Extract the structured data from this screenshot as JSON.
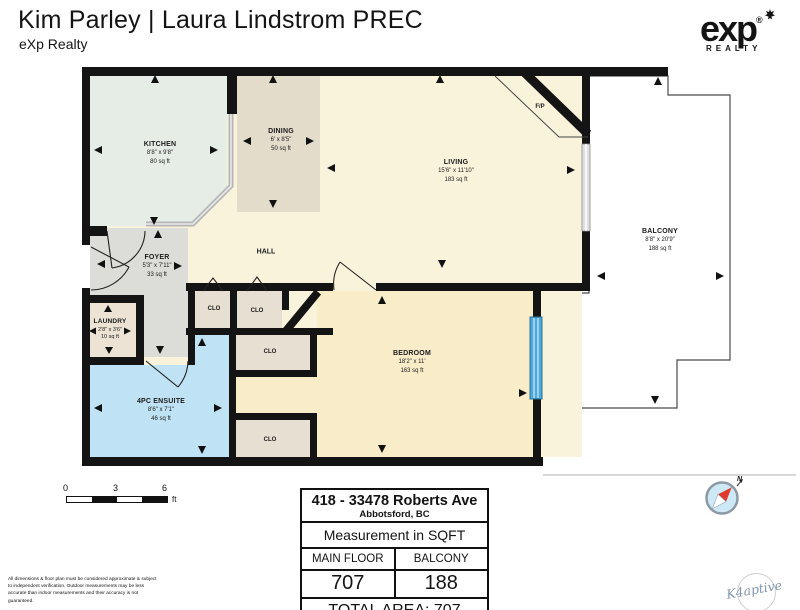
{
  "header": {
    "title": "Kim Parley | Laura Lindstrom PREC",
    "subtitle": "eXp Realty"
  },
  "brand": {
    "logo_text": "exp",
    "registered_mark": "®",
    "logo_sub": "REALTY"
  },
  "floorplan": {
    "rooms": [
      {
        "name": "KITCHEN",
        "dims": "8'8\" x 9'8\"",
        "area": "80 sq ft"
      },
      {
        "name": "DINING",
        "dims": "6' x 8'5\"",
        "area": "50 sq ft"
      },
      {
        "name": "LIVING",
        "dims": "15'6\" x 11'10\"",
        "area": "183 sq ft"
      },
      {
        "name": "BALCONY",
        "dims": "8'8\" x 20'9\"",
        "area": "188 sq ft"
      },
      {
        "name": "FOYER",
        "dims": "5'3\" x 7'11\"",
        "area": "33 sq ft"
      },
      {
        "name": "LAUNDRY",
        "dims": "2'8\" x 3'6\"",
        "area": "10 sq ft"
      },
      {
        "name": "4PC ENSUITE",
        "dims": "8'6\" x 7'1\"",
        "area": "46 sq ft"
      },
      {
        "name": "BEDROOM",
        "dims": "18'2\" x 11'",
        "area": "163 sq ft"
      }
    ],
    "labels": {
      "hall": "HALL",
      "fireplace": "F/P",
      "closet": "CLO"
    },
    "colors": {
      "hall": "#faf3dc",
      "kitchen": "#e6ede7",
      "dining": "#e3dccb",
      "foyer": "#dcdcd8",
      "laundry": "#ece3d4",
      "ensuite": "#bfe3f4",
      "closet": "#e7dfd1",
      "bedroom": "#f9ecc9",
      "wall": "#141414",
      "window_blue": "#4da9da"
    }
  },
  "scale_bar": {
    "ticks": [
      "0",
      "3",
      "6"
    ],
    "unit": "ft"
  },
  "summary_table": {
    "address_line1": "418 - 33478 Roberts Ave",
    "address_line2": "Abbotsford, BC",
    "measurement_label": "Measurement in SQFT",
    "columns": [
      {
        "label": "MAIN FLOOR",
        "value": "707"
      },
      {
        "label": "BALCONY",
        "value": "188"
      }
    ],
    "total": "TOTAL AREA: 707"
  },
  "disclaimer": "All dimensions & floor plan must be considered approximate & subject to independent verification.  Outdoor measurements may be less accurate than indoor measurements and their accuracy is not guaranteed.",
  "compass": {
    "north_label": "N"
  },
  "watermark": {
    "text": "K4aptive"
  }
}
